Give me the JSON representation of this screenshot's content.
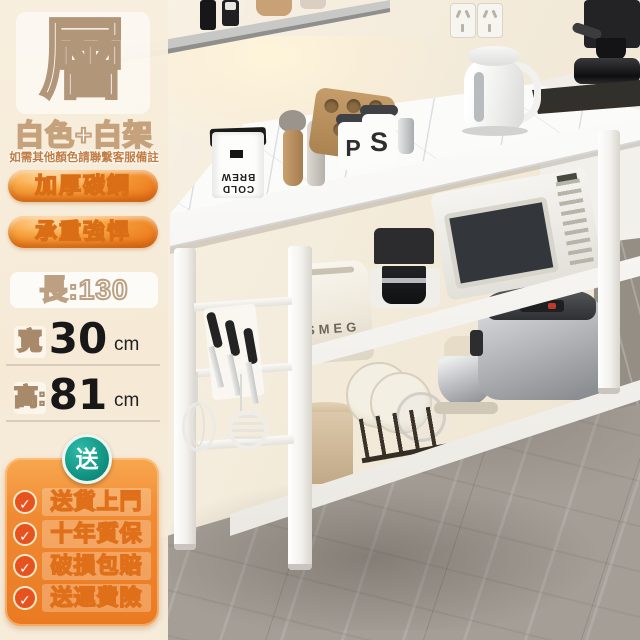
{
  "promo": {
    "tier_char": "層",
    "color_label": "白色+白架",
    "note": "如需其他顏色請聯繫客服備註",
    "feature_badges": [
      "加厚碳鋼",
      "承重強悍"
    ],
    "dimensions": {
      "length": "長:130",
      "width_label": "寬",
      "width_value": "30",
      "width_unit": "cm",
      "height_label": "高:",
      "height_value": "81",
      "height_unit": "cm"
    },
    "gift_badge": "送",
    "check_icon": "✓",
    "services": [
      "送貨上門",
      "十年質保",
      "破損包賠",
      "送運費險"
    ],
    "colors": {
      "accent_orange": "#ee8226",
      "teal_badge": "#0d8a7a",
      "cream_panel": "#f7ecd9",
      "outline_tan": "#b2967a"
    }
  },
  "scene": {
    "toaster_brand": "SMEG",
    "canister_letters": [
      "P",
      "S"
    ],
    "coffee_bag_line1": "COLD",
    "coffee_bag_line2": "BREW"
  }
}
